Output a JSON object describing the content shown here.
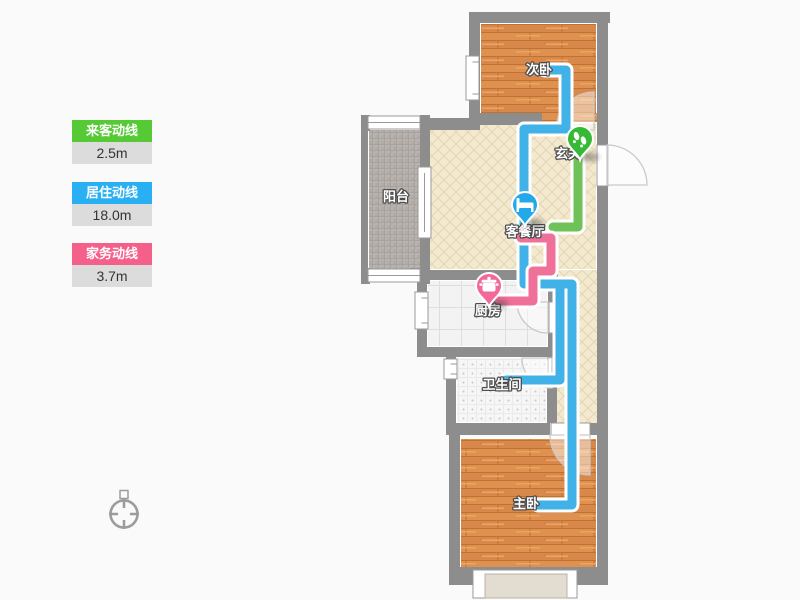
{
  "legend": {
    "items": [
      {
        "label": "来客动线",
        "value": "2.5m",
        "color": "#55ca34",
        "header_style": "background:#55ca34"
      },
      {
        "label": "居住动线",
        "value": "18.0m",
        "color": "#28b0f3",
        "header_style": "background:#28b0f3"
      },
      {
        "label": "家务动线",
        "value": "3.7m",
        "color": "#f4608a",
        "header_style": "background:#f4608a"
      }
    ],
    "value_bg": "#dcdcdc"
  },
  "floorplan": {
    "rooms": [
      {
        "name": "次卧"
      },
      {
        "name": "玄关"
      },
      {
        "name": "客餐厅"
      },
      {
        "name": "阳台"
      },
      {
        "name": "厨房"
      },
      {
        "name": "卫生间"
      },
      {
        "name": "主卧"
      }
    ],
    "routes": [
      {
        "name": "来客动线",
        "color": "#6ec257"
      },
      {
        "name": "居住动线",
        "color": "#41b2e8"
      },
      {
        "name": "家务动线",
        "color": "#ef7099"
      }
    ],
    "markers": [
      {
        "icon": "bed-icon",
        "room": "客餐厅",
        "color": "#23a8ea"
      },
      {
        "icon": "footprints-icon",
        "room": "玄关",
        "color": "#35ba35"
      },
      {
        "icon": "cooking-pot-icon",
        "room": "厨房",
        "color": "#f3679b"
      }
    ],
    "wall_color": "#8d8d8d"
  }
}
